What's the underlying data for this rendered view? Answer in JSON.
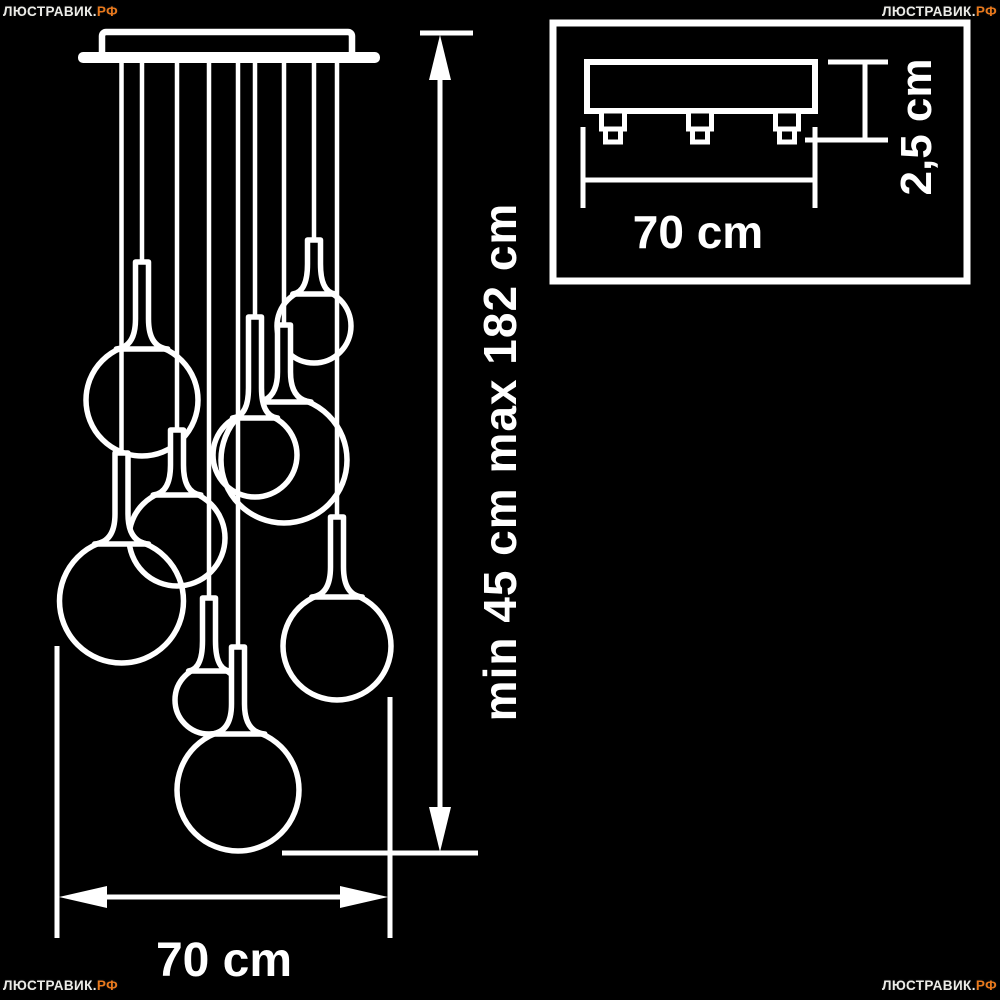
{
  "colors": {
    "background": "#000000",
    "line": "#ffffff",
    "watermark_main": "#ecece8",
    "watermark_suffix": "#e8791d"
  },
  "watermark": {
    "text_main": "ЛЮСТРАВИК.",
    "text_suffix": "РФ"
  },
  "labels": {
    "height_range": "min 45 cm max 182 cm",
    "width_bottom": "70 cm",
    "inset_width": "70 cm",
    "inset_thickness": "2,5 cm"
  },
  "diagram": {
    "canopy": {
      "bar": {
        "x": 78,
        "y": 52,
        "w": 302,
        "h": 11
      },
      "box": {
        "x": 102,
        "y": 32,
        "w": 250,
        "h": 26
      }
    },
    "pendants": [
      {
        "cx": 121.5,
        "neck_top": 453,
        "globe_cy": 601,
        "globe_r": 62
      },
      {
        "cx": 142,
        "neck_top": 262,
        "globe_cy": 400,
        "globe_r": 56
      },
      {
        "cx": 177,
        "neck_top": 430,
        "globe_cy": 538,
        "globe_r": 48
      },
      {
        "cx": 209,
        "neck_top": 598,
        "globe_cy": 700,
        "globe_r": 34
      },
      {
        "cx": 238,
        "neck_top": 647,
        "globe_cy": 790,
        "globe_r": 61
      },
      {
        "cx": 255,
        "neck_top": 317,
        "globe_cy": 455,
        "globe_r": 42
      },
      {
        "cx": 284,
        "neck_top": 325,
        "globe_cy": 460,
        "globe_r": 63
      },
      {
        "cx": 314,
        "neck_top": 240,
        "globe_cy": 326,
        "globe_r": 37
      },
      {
        "cx": 337,
        "neck_top": 517,
        "globe_cy": 646,
        "globe_r": 54
      }
    ],
    "dimensions": {
      "vertical": {
        "x": 440,
        "top_tick": {
          "y": 33,
          "x1": 420,
          "x2": 473
        },
        "arrow_top_tip_y": 35,
        "arrow_bottom_tip_y": 852,
        "line_y1": 72,
        "line_y2": 812,
        "ref_line": {
          "y": 853,
          "x1": 282,
          "x2": 478
        }
      },
      "horizontal": {
        "y": 897,
        "x1": 59,
        "x2": 388,
        "ext_left": {
          "x": 57,
          "y1": 646,
          "y2": 938
        },
        "ext_right": {
          "x": 390,
          "y1": 697,
          "y2": 938
        }
      }
    },
    "inset": {
      "box": {
        "x": 553,
        "y": 23,
        "w": 414,
        "h": 258
      },
      "plate": {
        "x": 587,
        "y": 62,
        "w": 228,
        "h": 49
      },
      "stub_centers": [
        613,
        700,
        787
      ],
      "stub_shape": {
        "top_w": 23,
        "top_h": 18,
        "bot_w": 15,
        "bot_h": 13
      },
      "dim_width": {
        "y": 180,
        "x1": 583,
        "x2": 815,
        "ext_y1": 127,
        "ext_y2": 208
      },
      "dim_thickness": {
        "x": 865,
        "y1": 62,
        "y2": 140,
        "top_tick_x1": 828,
        "bot_tick_x1": 805,
        "tick_x2": 888
      }
    }
  }
}
